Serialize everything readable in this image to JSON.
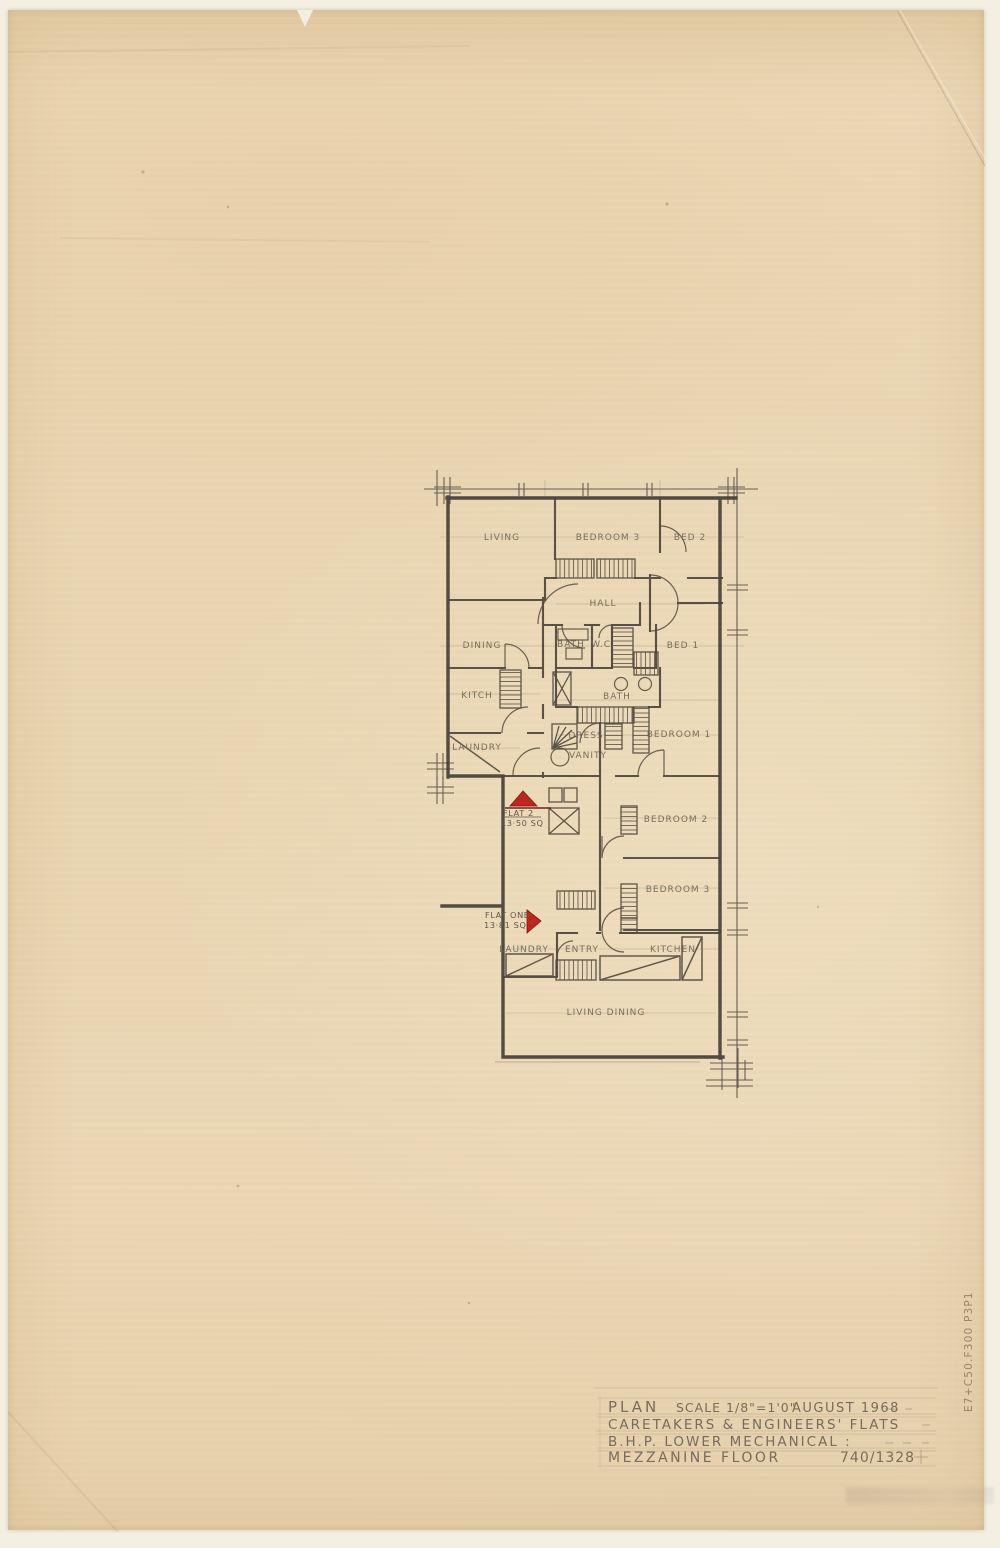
{
  "title_block": {
    "plan_word": "PLAN",
    "scale": "SCALE 1/8\"=1'0\"",
    "date": "AUGUST 1968",
    "line2": "CARETAKERS & ENGINEERS' FLATS",
    "line3": "B.H.P. LOWER MECHANICAL :",
    "line4": "MEZZANINE FLOOR",
    "drawing_number": "740/1328"
  },
  "plan": {
    "rooms": {
      "living": "LIVING",
      "bedroom3_upper": "BEDROOM 3",
      "bed2": "BED 2",
      "hall": "HALL",
      "dining": "DINING",
      "bath_upper": "BATH",
      "wc": "W.C.",
      "bed1": "BED 1",
      "kitch": "KITCH",
      "bath_lower": "BATH",
      "dress": "DRESS",
      "bedroom1": "BEDROOM 1",
      "laundry_upper": "LAUNDRY",
      "vanity": "VANITY",
      "bedroom2": "BEDROOM 2",
      "bedroom3_lower": "BEDROOM 3",
      "laundry_lower": "LAUNDRY",
      "entry": "ENTRY",
      "kitchen": "KITCHEN",
      "living_dining": "LIVING DINING"
    },
    "flat2": {
      "label": "FLAT 2",
      "area": "13·50 SQ"
    },
    "flat1": {
      "label": "FLAT ONE",
      "area": "13·81 SQ"
    }
  },
  "annotations": {
    "side_number": "E7+C50.F300 P3P1"
  },
  "colors": {
    "paper": "#e9d5b3",
    "scan_background": "#f3f0e3",
    "pencil_dark": "#46413a",
    "pencil_mid": "#5c544a",
    "pencil_light": "#8a7a60",
    "red_marker": "#bf241b"
  }
}
